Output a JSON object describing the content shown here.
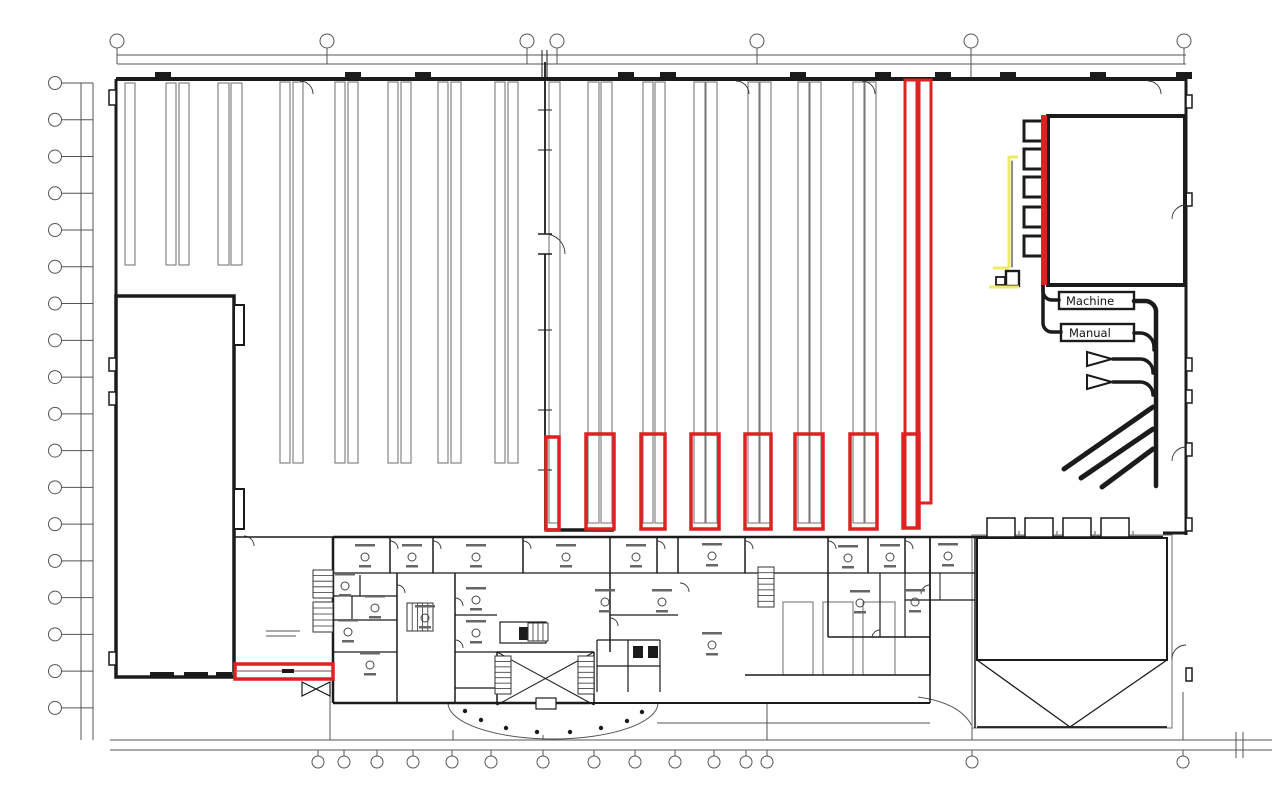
{
  "labels": {
    "machine": "Machine",
    "manual": "Manual"
  },
  "plan": {
    "colors": {
      "wall": "#1b1b1b",
      "rack": "#7a7a7a",
      "dim": "#555555",
      "red": "#de2121",
      "yellow": "#eeeb66"
    },
    "gray_lines": [
      [
        117,
        55,
        1186,
        55
      ],
      [
        117,
        64,
        1186,
        64
      ],
      [
        81,
        83,
        81,
        740
      ],
      [
        93,
        83,
        93,
        740
      ],
      [
        110,
        740,
        1272,
        740
      ],
      [
        110,
        750,
        1272,
        750
      ],
      [
        1236,
        732,
        1236,
        758
      ],
      [
        1243,
        732,
        1243,
        758
      ],
      [
        117,
        48,
        117,
        64
      ],
      [
        327,
        48,
        327,
        64
      ],
      [
        527,
        48,
        527,
        64
      ],
      [
        557,
        48,
        557,
        64
      ],
      [
        757,
        48,
        757,
        64
      ],
      [
        971,
        48,
        971,
        78
      ],
      [
        1184,
        48,
        1184,
        64
      ],
      [
        330,
        692,
        330,
        740
      ],
      [
        453,
        730,
        453,
        740
      ],
      [
        543,
        735,
        543,
        740
      ],
      [
        767,
        704,
        767,
        740
      ],
      [
        972,
        728,
        972,
        740
      ],
      [
        1183,
        692,
        1183,
        740
      ],
      [
        657,
        723,
        930,
        723
      ],
      [
        237,
        671,
        333,
        671
      ],
      [
        266,
        631,
        300,
        631
      ],
      [
        266,
        636,
        296,
        636
      ],
      [
        1019,
        531,
        1019,
        542
      ],
      [
        1057,
        531,
        1057,
        542
      ],
      [
        1095,
        531,
        1095,
        542
      ],
      [
        1133,
        531,
        1133,
        542
      ]
    ],
    "gray_paths": [
      "M448 703 a105 36 0 0 0 210 0",
      "M918 697 q44 6 55 31"
    ],
    "racks": [
      [
        125,
        83,
        10,
        182
      ],
      [
        166,
        83,
        10,
        182
      ],
      [
        179,
        83,
        10,
        182
      ],
      [
        218,
        83,
        11,
        182
      ],
      [
        231,
        83,
        11,
        182
      ],
      [
        280,
        82,
        10,
        381
      ],
      [
        293,
        82,
        10,
        381
      ],
      [
        335,
        82,
        10,
        381
      ],
      [
        348,
        82,
        10,
        381
      ],
      [
        388,
        82,
        10,
        381
      ],
      [
        401,
        82,
        10,
        381
      ],
      [
        438,
        82,
        10,
        381
      ],
      [
        451,
        82,
        10,
        381
      ],
      [
        495,
        82,
        10,
        381
      ],
      [
        508,
        82,
        10,
        381
      ],
      [
        549,
        82,
        11,
        441
      ],
      [
        588,
        82,
        11,
        441
      ],
      [
        601,
        82,
        11,
        441
      ],
      [
        643,
        82,
        10,
        441
      ],
      [
        655,
        82,
        10,
        441
      ],
      [
        694,
        82,
        11,
        441
      ],
      [
        706,
        82,
        11,
        441
      ],
      [
        748,
        82,
        11,
        441
      ],
      [
        760,
        82,
        11,
        441
      ],
      [
        798,
        82,
        11,
        441
      ],
      [
        810,
        82,
        11,
        441
      ],
      [
        853,
        82,
        11,
        441
      ],
      [
        865,
        82,
        11,
        441
      ],
      [
        783,
        602,
        30,
        73
      ],
      [
        823,
        602,
        30,
        73
      ],
      [
        863,
        602,
        32,
        73
      ],
      [
        972,
        535,
        200,
        193
      ]
    ],
    "walls": [
      [
        116,
        79,
        1186,
        79,
        4
      ],
      [
        116,
        79,
        116,
        298,
        3
      ],
      [
        1186,
        79,
        1186,
        535,
        3
      ],
      [
        1163,
        533,
        1186,
        533,
        3
      ],
      [
        975,
        537,
        1163,
        537,
        2.5
      ],
      [
        234,
        537,
        333,
        537,
        1.5
      ],
      [
        546,
        530,
        614,
        530,
        3.5
      ],
      [
        545,
        62,
        545,
        234,
        1.8
      ],
      [
        545,
        254,
        545,
        530,
        1.8
      ],
      [
        538,
        110,
        552,
        110,
        1
      ],
      [
        538,
        150,
        552,
        150,
        1
      ],
      [
        538,
        234,
        552,
        234,
        1.5
      ],
      [
        538,
        254,
        552,
        254,
        1.5
      ],
      [
        538,
        330,
        552,
        330,
        1
      ],
      [
        538,
        410,
        552,
        410,
        1
      ],
      [
        538,
        470,
        552,
        470,
        1
      ],
      [
        542,
        50,
        542,
        79,
        1
      ],
      [
        547,
        50,
        547,
        79,
        1
      ],
      [
        116,
        503,
        234,
        503,
        3
      ],
      [
        116,
        549,
        234,
        549,
        3
      ],
      [
        116,
        576,
        234,
        576,
        2
      ],
      [
        333,
        537,
        975,
        537,
        2.5
      ],
      [
        333,
        537,
        333,
        703,
        2.5
      ],
      [
        333,
        703,
        590,
        703,
        2.5
      ],
      [
        590,
        703,
        930,
        703,
        2
      ],
      [
        745,
        675,
        930,
        675,
        1.5
      ],
      [
        930,
        675,
        930,
        703,
        1.5
      ],
      [
        930,
        537,
        930,
        675,
        1.8
      ],
      [
        975,
        537,
        975,
        728,
        1.5
      ],
      [
        390,
        537,
        390,
        573,
        1.5
      ],
      [
        433,
        537,
        433,
        573,
        1.5
      ],
      [
        523,
        537,
        523,
        573,
        1.5
      ],
      [
        610,
        537,
        610,
        573,
        1.5
      ],
      [
        657,
        537,
        657,
        573,
        1.5
      ],
      [
        678,
        537,
        678,
        573,
        1.5
      ],
      [
        745,
        537,
        745,
        573,
        1.5
      ],
      [
        828,
        537,
        828,
        573,
        1.5
      ],
      [
        868,
        537,
        868,
        573,
        1.5
      ],
      [
        905,
        537,
        905,
        573,
        1.5
      ],
      [
        333,
        573,
        975,
        573,
        1.3
      ],
      [
        397,
        573,
        397,
        703,
        1.5
      ],
      [
        455,
        573,
        455,
        703,
        1.5
      ],
      [
        455,
        615,
        497,
        615,
        1.2
      ],
      [
        455,
        652,
        497,
        652,
        1.2
      ],
      [
        455,
        688,
        497,
        688,
        1.2
      ],
      [
        497,
        652,
        594,
        652,
        1.5
      ],
      [
        497,
        652,
        497,
        705,
        1.5
      ],
      [
        594,
        652,
        594,
        705,
        1.5
      ],
      [
        497,
        652,
        594,
        705,
        1
      ],
      [
        497,
        705,
        594,
        652,
        1
      ],
      [
        610,
        573,
        610,
        652,
        1.5
      ],
      [
        610,
        615,
        678,
        615,
        1.2
      ],
      [
        597,
        640,
        660,
        640,
        1.2
      ],
      [
        597,
        640,
        597,
        692,
        1.2
      ],
      [
        660,
        640,
        660,
        692,
        1.2
      ],
      [
        628,
        640,
        628,
        692,
        1.2
      ],
      [
        597,
        666,
        660,
        666,
        1.2
      ],
      [
        828,
        573,
        828,
        637,
        1.5
      ],
      [
        828,
        637,
        930,
        637,
        1.5
      ],
      [
        880,
        573,
        880,
        637,
        1.2
      ],
      [
        905,
        573,
        905,
        637,
        1.2
      ],
      [
        905,
        600,
        975,
        600,
        1.2
      ],
      [
        940,
        573,
        940,
        600,
        1
      ],
      [
        333,
        596,
        397,
        596,
        1.2
      ],
      [
        333,
        620,
        397,
        620,
        1.2
      ],
      [
        360,
        575,
        360,
        596,
        1.2
      ],
      [
        352,
        596,
        352,
        620,
        1.2
      ],
      [
        333,
        652,
        397,
        652,
        1.2
      ],
      [
        977,
        660,
        1070,
        727,
        1.3
      ],
      [
        1167,
        660,
        1070,
        727,
        1.3
      ],
      [
        977,
        727,
        1167,
        727,
        1.8
      ]
    ],
    "bold_rects": [
      [
        116,
        296,
        118,
        381,
        3.5
      ],
      [
        234,
        305,
        10,
        40,
        2
      ],
      [
        234,
        489,
        10,
        40,
        2
      ],
      [
        109,
        90,
        7,
        15,
        1.5
      ],
      [
        109,
        358,
        7,
        13,
        1.5
      ],
      [
        109,
        392,
        7,
        13,
        1.5
      ],
      [
        109,
        652,
        7,
        13,
        1.5
      ],
      [
        1186,
        95,
        6,
        13,
        1.5
      ],
      [
        1186,
        193,
        6,
        13,
        1.5
      ],
      [
        1186,
        358,
        6,
        13,
        1.5
      ],
      [
        1186,
        390,
        6,
        13,
        1.5
      ],
      [
        1186,
        443,
        6,
        13,
        1.5
      ],
      [
        1186,
        518,
        6,
        13,
        1.5
      ],
      [
        1186,
        668,
        6,
        13,
        1.5
      ],
      [
        1024,
        121,
        21,
        20,
        3
      ],
      [
        1024,
        149,
        21,
        20,
        3
      ],
      [
        1024,
        177,
        21,
        20,
        3
      ],
      [
        1024,
        207,
        21,
        20,
        3
      ],
      [
        1024,
        236,
        21,
        20,
        3
      ],
      [
        1048,
        116,
        137,
        169,
        4
      ],
      [
        1006,
        271,
        13,
        15,
        2.4
      ],
      [
        996,
        277,
        9,
        8,
        1.8
      ],
      [
        987,
        518,
        28,
        19,
        1.5
      ],
      [
        1025,
        518,
        28,
        19,
        1.5
      ],
      [
        1063,
        518,
        28,
        19,
        1.5
      ],
      [
        1101,
        518,
        28,
        19,
        1.5
      ],
      [
        977,
        538,
        190,
        122,
        2
      ],
      [
        500,
        622,
        46,
        21,
        1.2
      ],
      [
        536,
        698,
        20,
        11,
        1.2
      ]
    ],
    "fill_rects": [
      [
        155,
        72,
        16,
        7
      ],
      [
        345,
        72,
        16,
        7
      ],
      [
        415,
        72,
        16,
        7
      ],
      [
        618,
        72,
        16,
        7
      ],
      [
        660,
        72,
        16,
        7
      ],
      [
        790,
        72,
        16,
        7
      ],
      [
        875,
        72,
        16,
        7
      ],
      [
        935,
        72,
        16,
        7
      ],
      [
        1000,
        72,
        16,
        7
      ],
      [
        1090,
        72,
        16,
        7
      ],
      [
        1176,
        72,
        16,
        7
      ],
      [
        519,
        627,
        10,
        13
      ],
      [
        532,
        627,
        10,
        13
      ],
      [
        633,
        646,
        10,
        12
      ],
      [
        648,
        646,
        10,
        12
      ],
      [
        282,
        669,
        12,
        4
      ],
      [
        150,
        672,
        24,
        5
      ],
      [
        184,
        672,
        24,
        5
      ],
      [
        216,
        672,
        16,
        5
      ]
    ],
    "black_paths": [
      [
        "M1043 285 v6 a9 9 0 0 0 9 9 h7",
        3.5
      ],
      [
        "M1043 285 v38 a9 9 0 0 0 9 9 h9",
        3.5
      ],
      [
        "M1134 301 h11 a11 11 0 0 1 11 12 v173",
        4.5
      ],
      [
        "M1134 333 h6 a14 14 0 0 1 14 14 v3",
        3.5
      ],
      [
        "M1113 359 h27 a13 13 0 0 1 13 13 v1",
        3.5
      ],
      [
        "M1113 382 h27 a13 13 0 0 1 13 12 v1",
        3.5
      ],
      [
        "M1012 161 v106",
        1
      ],
      [
        "M302 682 L330 696 L330 682 L302 696 Z",
        1.2
      ]
    ],
    "diagonals": [
      [
        1064,
        469,
        1153,
        407
      ],
      [
        1081,
        478,
        1153,
        429
      ],
      [
        1102,
        487,
        1153,
        449
      ]
    ],
    "funnels": [
      "1087,352 1087,366 1112,359",
      "1087,375 1087,389 1112,382"
    ],
    "door_paths": [
      "M300 81 a13 13 0 0 1 13 13",
      "M736 81 a13 13 0 0 1 13 13",
      "M862 81 a13 13 0 0 1 13 13",
      "M1148 81 a13 13 0 0 1 13 13",
      "M1186 205 a14 14 0 0 0 -14 14",
      "M1186 447 a14 14 0 0 0 -14 14",
      "M1186 645 a14 14 0 0 0 -14 14",
      "M244 536 a10 10 0 0 1 10 10",
      "M545 234 a20 20 0 0 1 20 20",
      "M390 541 a8 8 0 0 1 8 8",
      "M433 541 a8 8 0 0 1 8 8",
      "M523 541 a8 8 0 0 1 8 8",
      "M657 541 a8 8 0 0 1 8 8",
      "M745 541 a8 8 0 0 1 8 8",
      "M828 541 a8 8 0 0 1 8 8",
      "M905 541 a8 8 0 0 1 8 8",
      "M455 598 a8 8 0 0 1 8 8",
      "M455 640 a8 8 0 0 1 8 8",
      "M610 618 a8 8 0 0 1 8 8",
      "M397 585 a8 8 0 0 1 8 8",
      "M930 585 a9 9 0 0 0 -9 9",
      "M880 630 a8 8 0 0 0 -8 8",
      "M680 583 a9 9 0 0 1 9 9"
    ],
    "stairs": [
      [
        313,
        570,
        20,
        28,
        5,
        "h"
      ],
      [
        313,
        602,
        20,
        30,
        5,
        "h"
      ],
      [
        407,
        603,
        26,
        28,
        5,
        "v"
      ],
      [
        495,
        656,
        16,
        38,
        7,
        "h"
      ],
      [
        578,
        656,
        16,
        38,
        7,
        "h"
      ],
      [
        758,
        567,
        16,
        40,
        7,
        "h"
      ],
      [
        528,
        623,
        20,
        18,
        4,
        "v"
      ]
    ],
    "furniture": [
      [
        365,
        557
      ],
      [
        412,
        557
      ],
      [
        476,
        557
      ],
      [
        566,
        557
      ],
      [
        636,
        557
      ],
      [
        712,
        556
      ],
      [
        848,
        558
      ],
      [
        890,
        557
      ],
      [
        948,
        556
      ],
      [
        345,
        586
      ],
      [
        375,
        608
      ],
      [
        348,
        632
      ],
      [
        425,
        618
      ],
      [
        476,
        600
      ],
      [
        476,
        633
      ],
      [
        605,
        602
      ],
      [
        662,
        602
      ],
      [
        712,
        645
      ],
      [
        860,
        603
      ],
      [
        915,
        602
      ],
      [
        370,
        665
      ]
    ],
    "arc_dots": [
      [
        642,
        712
      ],
      [
        627,
        721
      ],
      [
        601,
        728
      ],
      [
        570,
        732
      ],
      [
        537,
        732
      ],
      [
        506,
        728
      ],
      [
        481,
        720
      ],
      [
        465,
        711
      ]
    ],
    "red_boxes": [
      [
        546,
        437,
        13,
        93,
        3.5
      ],
      [
        586,
        434,
        28,
        95,
        3.5
      ],
      [
        641,
        434,
        24,
        95,
        3.5
      ],
      [
        691,
        434,
        28,
        95,
        3.5
      ],
      [
        745,
        434,
        26,
        95,
        3.5
      ],
      [
        795,
        434,
        28,
        95,
        3.5
      ],
      [
        850,
        434,
        27,
        95,
        3.5
      ],
      [
        903,
        434,
        16,
        94,
        3.5
      ],
      [
        905,
        80,
        12,
        448,
        3
      ],
      [
        919,
        80,
        12,
        423,
        3
      ],
      [
        235,
        664,
        98,
        15,
        3.5
      ]
    ],
    "red_fills": [
      [
        1041,
        115,
        6,
        170
      ]
    ],
    "yellow_paths": [
      "M1009 157 h9",
      "M1009 156 v112",
      "M993 268 h16",
      "M989 287 h30"
    ],
    "bubbles": {
      "left": {
        "cx": 55,
        "r": 6.5,
        "y0": 83,
        "step": 36.76,
        "count": 18
      },
      "top": {
        "cy": 41,
        "r": 7,
        "xs": [
          117,
          327,
          527,
          557,
          757,
          971,
          1184
        ]
      },
      "bottom": {
        "cy": 762,
        "r": 6,
        "xs": [
          318,
          344,
          377,
          413,
          452,
          491,
          543,
          594,
          635,
          675,
          714,
          746,
          767,
          972,
          1183
        ]
      }
    }
  }
}
